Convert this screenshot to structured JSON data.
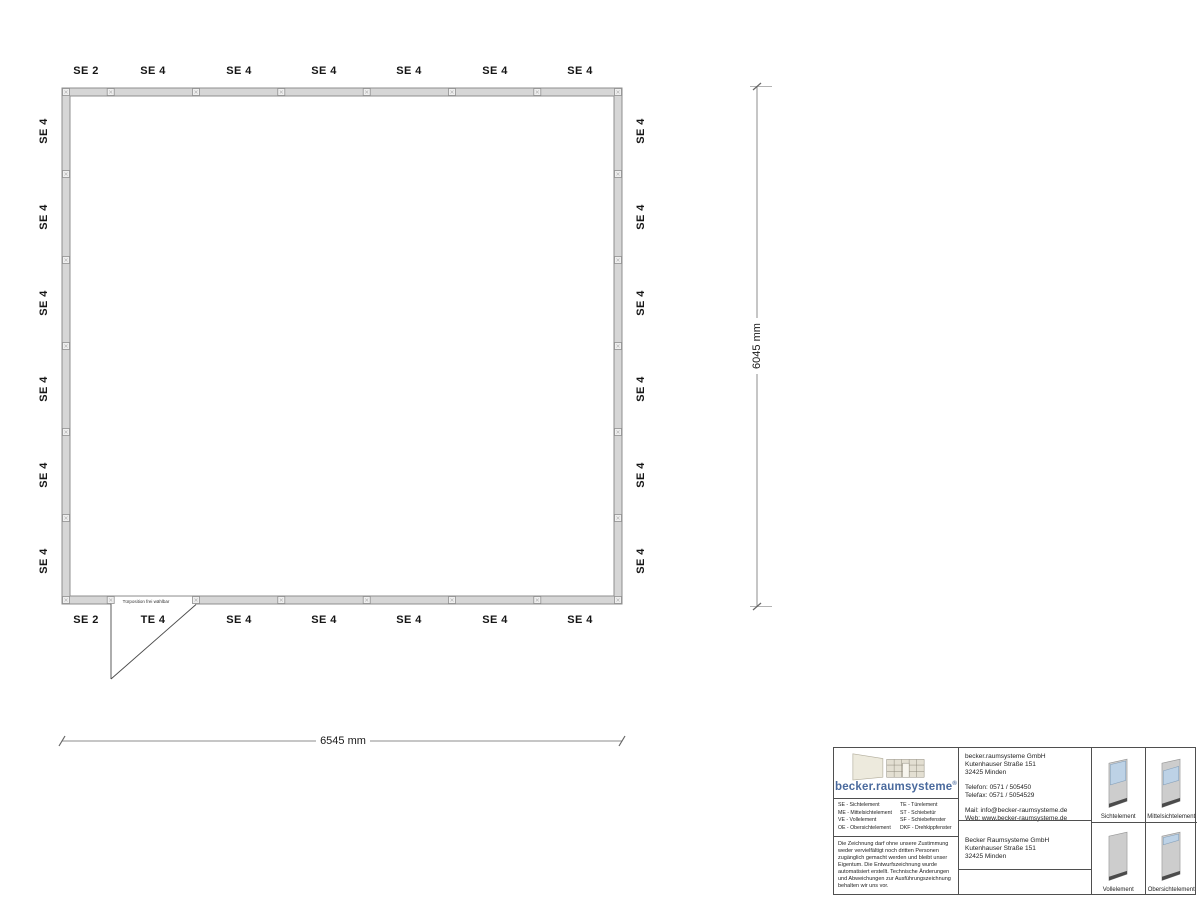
{
  "colors": {
    "accent": "#4a6a9d",
    "glass": "#bdd2e6",
    "wall-fill": "#d6d6d6",
    "wall-stroke": "#8f8f8f",
    "base-dark": "#4b4b4b"
  },
  "plan": {
    "top_labels": [
      "SE 2",
      "SE 4",
      "SE 4",
      "SE 4",
      "SE 4",
      "SE 4",
      "SE 4"
    ],
    "bottom_labels": [
      "SE 2",
      "TE 4",
      "SE 4",
      "SE 4",
      "SE 4",
      "SE 4",
      "SE 4"
    ],
    "left_labels": [
      "SE 4",
      "SE 4",
      "SE 4",
      "SE 4",
      "SE 4",
      "SE 4"
    ],
    "right_labels": [
      "SE 4",
      "SE 4",
      "SE 4",
      "SE 4",
      "SE 4",
      "SE 4"
    ],
    "door_note": "Türposition frei wählbar",
    "width_dim": "6545 mm",
    "height_dim": "6045 mm"
  },
  "titleblock": {
    "logo": {
      "text": "becker.raumsysteme",
      "reg": "®"
    },
    "legend": [
      [
        "SE - Sichtelement",
        "TE - Türelement"
      ],
      [
        "ME - Mittelsichtelement",
        "ST - Schiebetür"
      ],
      [
        "VE - Vollelement",
        "SF - Schiebefenster"
      ],
      [
        "OE - Obersichtelement",
        "DKF - Drehkippfenster"
      ]
    ],
    "contact": {
      "name": "becker.raumsysteme GmbH",
      "street": "Kutenhauser Straße 151",
      "city": "32425 Minden",
      "phone": "Telefon: 0571 / 505450",
      "fax": "Telefax: 0571 / 5054529",
      "mail": "Mail: info@becker-raumsysteme.de",
      "web": "Web: www.becker-raumsysteme.de"
    },
    "notice": "Die Zeichnung darf ohne unsere Zustimmung weder vervielfältigt noch dritten Personen zugänglich gemacht werden und bleibt unser Eigentum. Die Entwurfszeichnung wurde automatisiert erstellt. Technische Änderungen und Abweichungen zur Ausführungszeichnung behalten wir uns vor.",
    "company": {
      "name": "Becker Raumsysteme GmbH",
      "street": "Kutenhauser Straße 151",
      "city": "32425 Minden"
    },
    "element_cards": [
      {
        "label": "Sichtelement"
      },
      {
        "label": "Mittelsichtelement"
      },
      {
        "label": "Vollelement"
      },
      {
        "label": "Obersichtelement"
      }
    ]
  }
}
